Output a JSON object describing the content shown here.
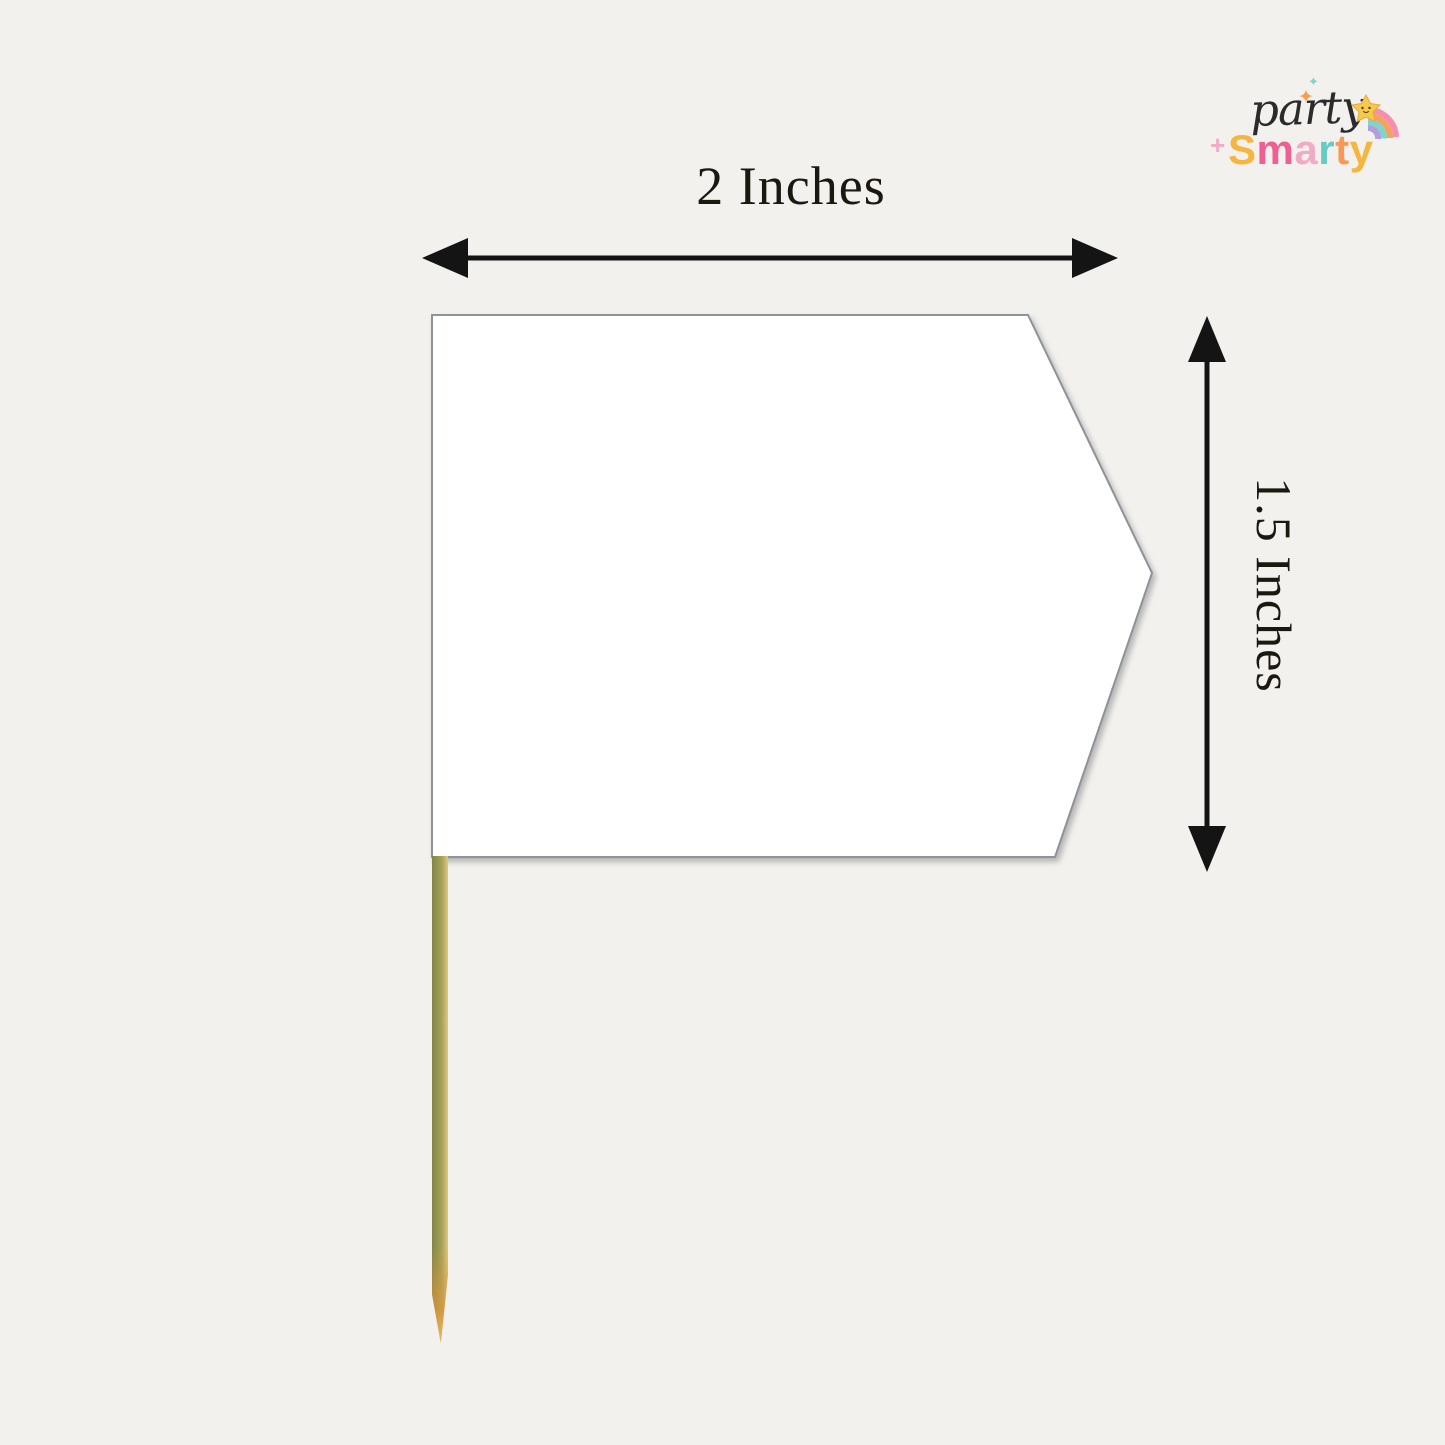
{
  "page": {
    "background": "#f3f1ed"
  },
  "logo": {
    "word1": "party",
    "word1_color": "#2b2b2b",
    "word2": "Smarty",
    "word2_letters": [
      {
        "ch": "S",
        "color": "#f6b53f"
      },
      {
        "ch": "m",
        "color": "#ef5f94"
      },
      {
        "ch": "a",
        "color": "#f2abc6"
      },
      {
        "ch": "r",
        "color": "#66cbc4"
      },
      {
        "ch": "t",
        "color": "#f79a58"
      },
      {
        "ch": "y",
        "color": "#f6b53f"
      }
    ],
    "icons": {
      "sparkle": "✦",
      "plus": "+"
    },
    "sparkle_colors": {
      "small": "#7fd4cd",
      "large": "#f6a04f",
      "plus": "#f2abc6"
    },
    "star_color": "#f7c94b",
    "star_outline": "#e8a93c",
    "tail_colors": [
      "#f48fb1",
      "#f5a25d",
      "#7fd4cd",
      "#b39ddb"
    ]
  },
  "dimensions": {
    "width_label": "2 Inches",
    "height_label": "1.5 Inches",
    "label_color": "#1b1810"
  },
  "figure": {
    "flag_fill": "#ffffff",
    "flag_border": "#8d939b",
    "arrow_color": "#141414",
    "stick_colors": {
      "left": "#85854a",
      "mid": "#a8a55c",
      "right": "#ddc87e",
      "tip": "#df963c"
    }
  }
}
